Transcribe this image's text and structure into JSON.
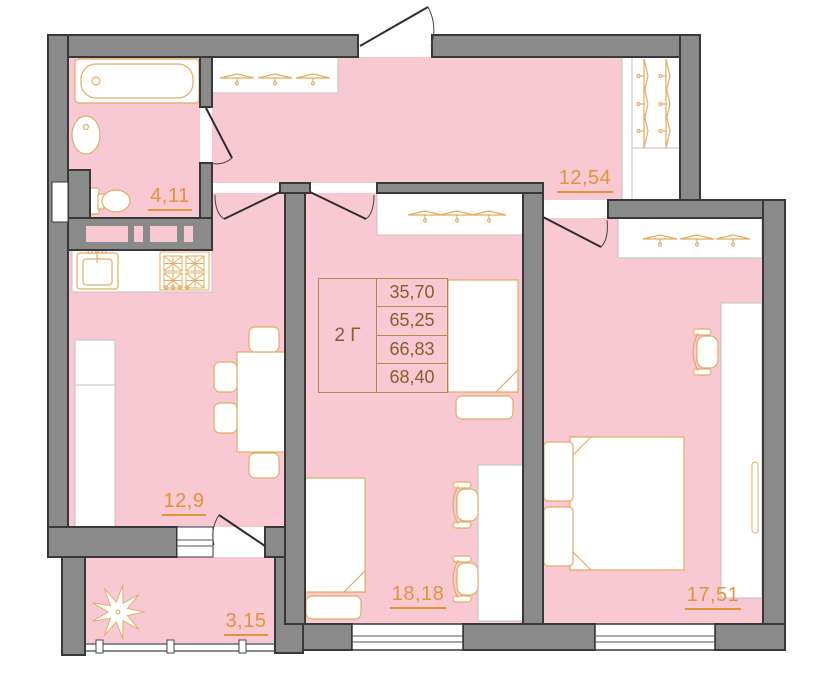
{
  "plan": {
    "unit_table": {
      "type_label": "2 Г",
      "values": [
        "35,70",
        "65,25",
        "66,83",
        "68,40"
      ]
    },
    "rooms": [
      {
        "name": "bathroom",
        "area": "4,11"
      },
      {
        "name": "hallway",
        "area": "12,54"
      },
      {
        "name": "kitchen",
        "area": "12,9"
      },
      {
        "name": "living-room",
        "area": "18,18"
      },
      {
        "name": "bedroom",
        "area": "17,51"
      },
      {
        "name": "balcony",
        "area": "3,15"
      }
    ],
    "colors": {
      "room_fill": "#F8C9D3",
      "wall_fill": "#8A8A8A",
      "wall_outline": "#383838",
      "furniture_outline": "#E3AC61",
      "label_color": "#DF9537",
      "table_text": "#8A5D2B",
      "table_border": "#B3894D"
    }
  }
}
